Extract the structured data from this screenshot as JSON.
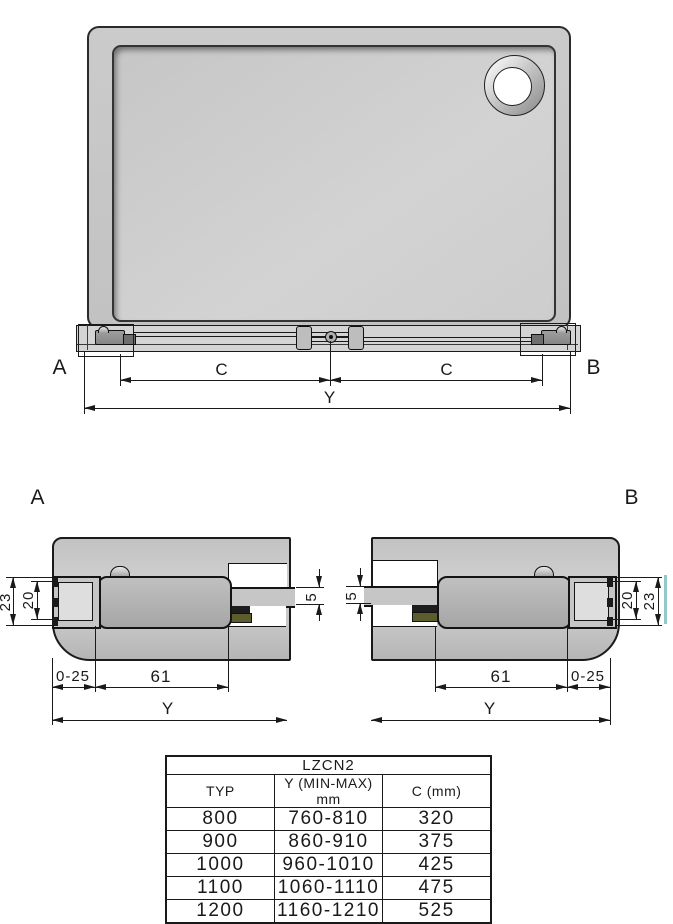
{
  "top_view": {
    "label_a": "A",
    "label_b": "B",
    "dim_c": "C",
    "dim_y": "Y"
  },
  "section_a": {
    "label": "A",
    "dim_outer_height": "23",
    "dim_inner_height": "20",
    "dim_glass_thickness": "5",
    "dim_adjust_range": "0-25",
    "dim_bracket_width": "61",
    "dim_y": "Y"
  },
  "section_b": {
    "label": "B",
    "dim_outer_height": "23",
    "dim_inner_height": "20",
    "dim_glass_thickness": "5",
    "dim_adjust_range": "0-25",
    "dim_bracket_width": "61",
    "dim_y": "Y"
  },
  "table": {
    "title": "LZCN2",
    "columns": [
      "TYP",
      "Y (MIN-MAX) mm",
      "C (mm)"
    ],
    "rows": [
      [
        "800",
        "760-810",
        "320"
      ],
      [
        "900",
        "860-910",
        "375"
      ],
      [
        "1000",
        "960-1010",
        "425"
      ],
      [
        "1100",
        "1060-1110",
        "475"
      ],
      [
        "1200",
        "1160-1210",
        "525"
      ]
    ]
  },
  "colors": {
    "line": "#1a1a1a",
    "tray_fill": "#c9c9c9",
    "bracket_fill": "#adadad",
    "seal_olive": "#5c5c2c",
    "glass_edge_teal": "#8fc9c9"
  }
}
